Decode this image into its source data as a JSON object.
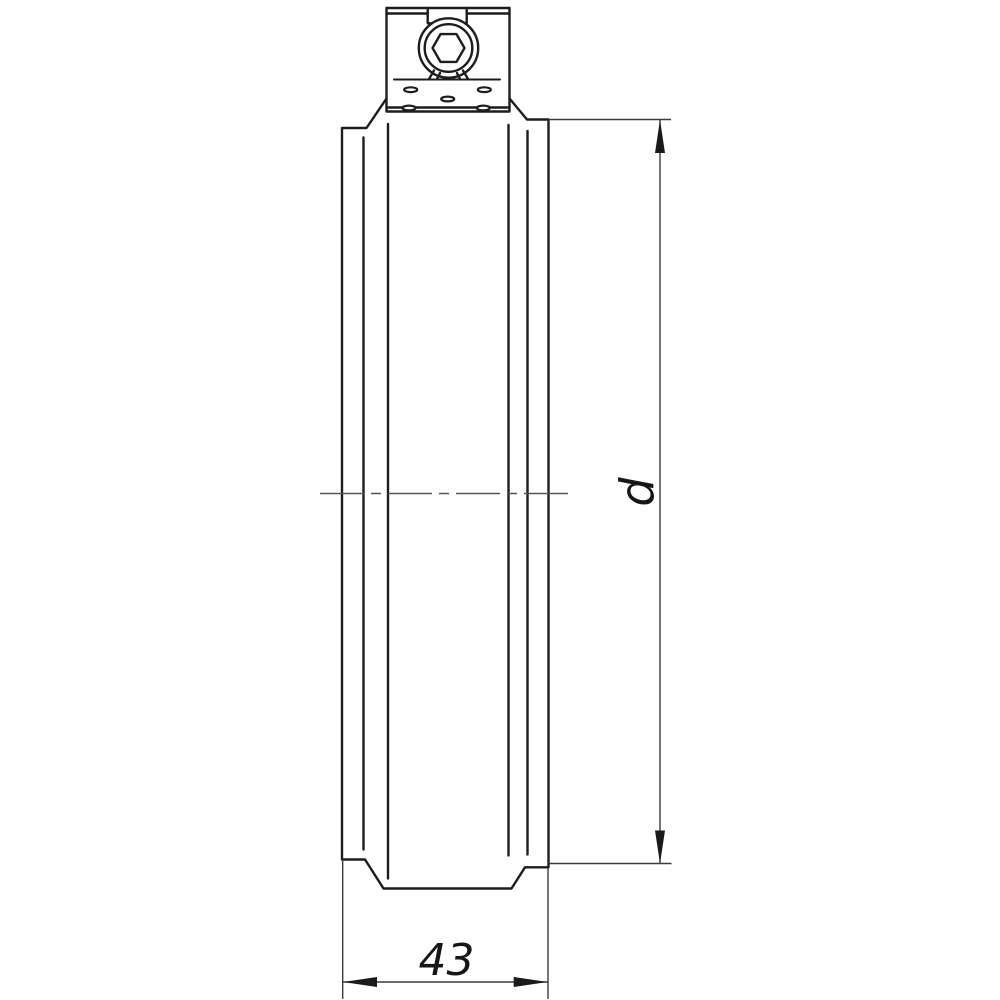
{
  "page": {
    "background": "#ffffff"
  },
  "drawing": {
    "labels": {
      "width_dimension": "43",
      "diameter_dimension": "d"
    },
    "colors": {
      "outline": "#1d1d1d",
      "thin_line": "#3d3d3d",
      "centerline": "#555555",
      "arrow": "#1a1a1a",
      "background": "#ffffff"
    }
  }
}
